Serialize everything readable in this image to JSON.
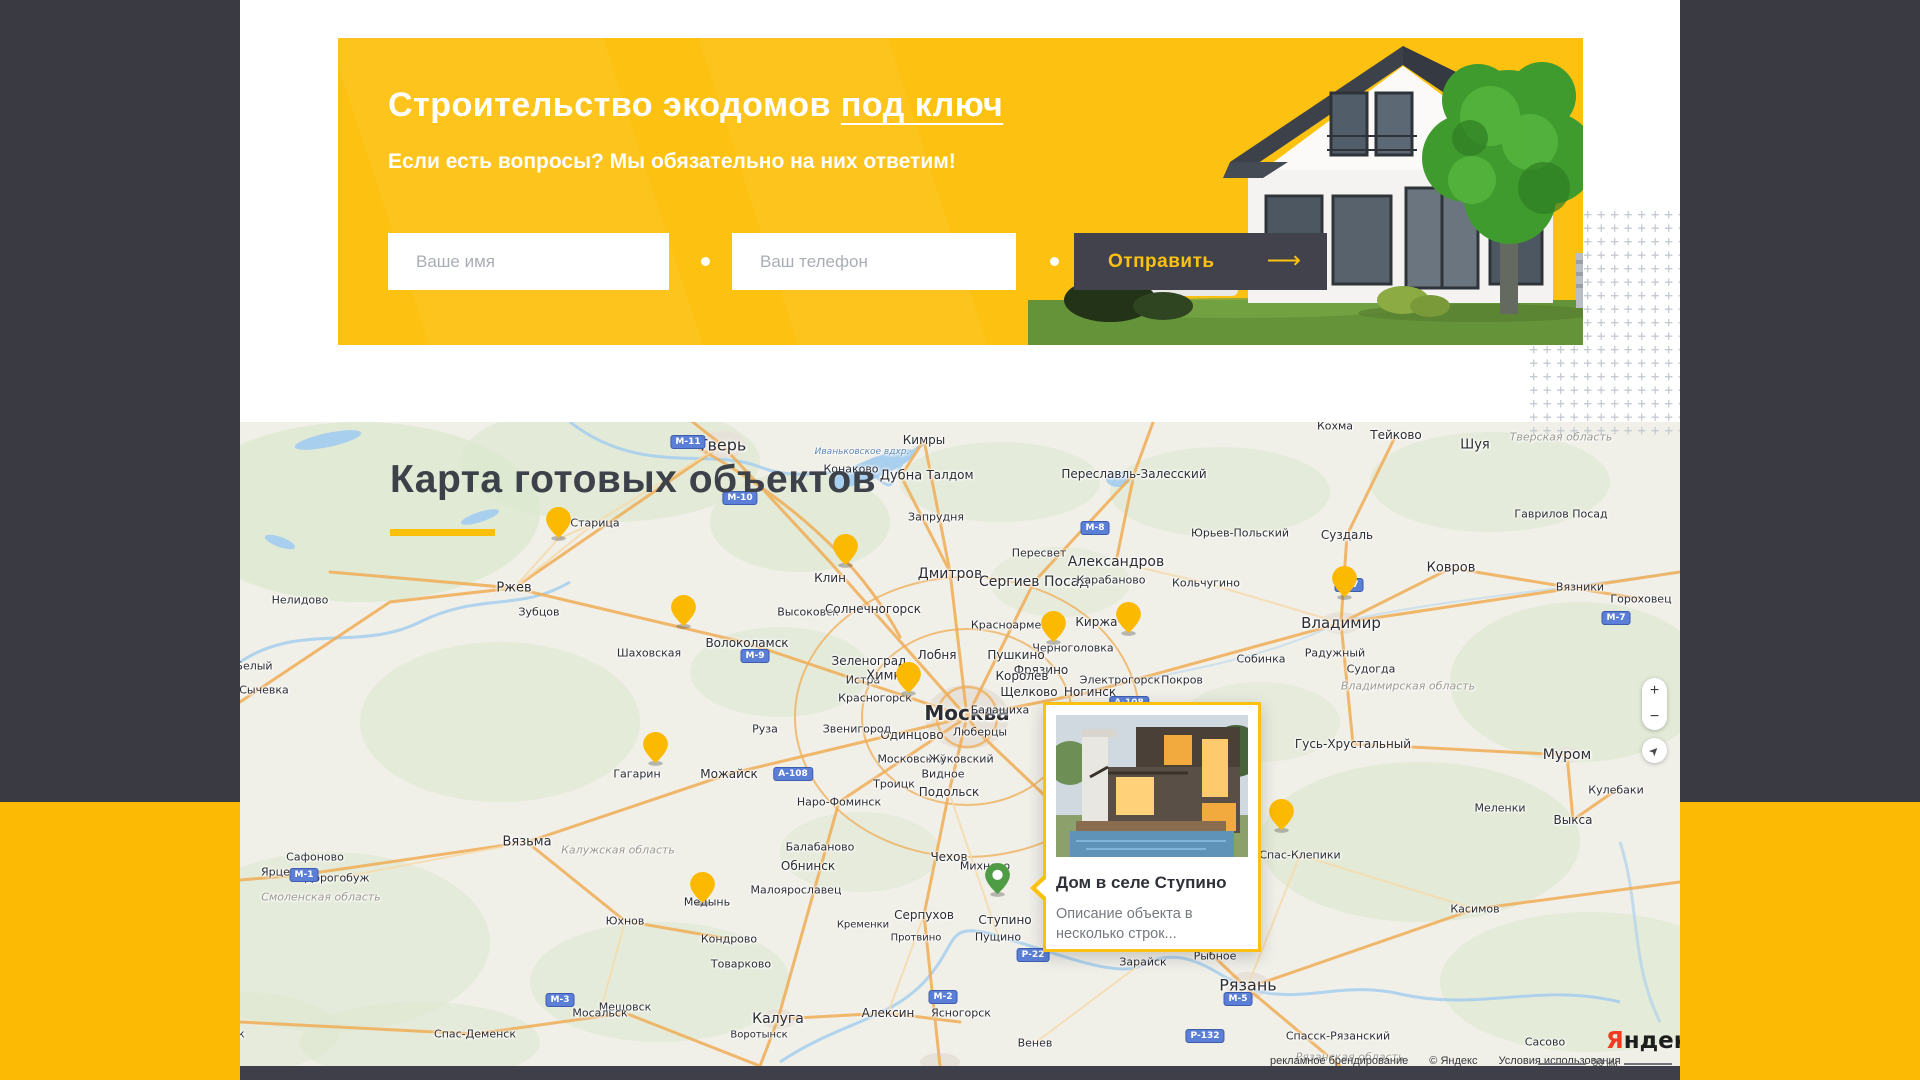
{
  "banner": {
    "title_main": "Строительство экодомов",
    "title_underlined": "под ключ",
    "subtitle": "Если есть вопросы? Мы обязательно на них ответим!",
    "form": {
      "name_placeholder": "Ваше имя",
      "phone_placeholder": "Ваш телефон",
      "submit_label": "Отправить",
      "submit_arrow": "⟶"
    }
  },
  "map_section": {
    "title": "Карта готовых объектов",
    "popup": {
      "title": "Дом в селе Ступино",
      "description": "Описание объекта в несколько строк..."
    },
    "controls": {
      "zoom_in": "+",
      "zoom_out": "−",
      "geolocate_icon": "➤"
    },
    "logo": {
      "first_letter": "Я",
      "rest": "ндекс"
    },
    "scale_label": "30 км",
    "attribution_left": "рекламное брендирование",
    "attribution_copyright": "© Яндекс",
    "attribution_terms": "Условия использования",
    "colors": {
      "pin_yellow": "#fcb902",
      "pin_green": "#4e9c44",
      "accent": "#fdc111"
    },
    "pins": [
      {
        "x": 318,
        "y": 117,
        "color": "yellow"
      },
      {
        "x": 605,
        "y": 144,
        "color": "yellow"
      },
      {
        "x": 443,
        "y": 205,
        "color": "yellow"
      },
      {
        "x": 813,
        "y": 221,
        "color": "yellow"
      },
      {
        "x": 888,
        "y": 212,
        "color": "yellow"
      },
      {
        "x": 1104,
        "y": 176,
        "color": "yellow"
      },
      {
        "x": 668,
        "y": 272,
        "color": "yellow"
      },
      {
        "x": 415,
        "y": 342,
        "color": "yellow"
      },
      {
        "x": 1041,
        "y": 409,
        "color": "yellow"
      },
      {
        "x": 462,
        "y": 482,
        "color": "yellow"
      },
      {
        "x": 757,
        "y": 473,
        "color": "green"
      }
    ],
    "labels": [
      {
        "t": "Тверь",
        "x": 482,
        "y": 23,
        "s": 16,
        "k": "c"
      },
      {
        "t": "Кимры",
        "x": 684,
        "y": 18,
        "s": 12,
        "k": "c"
      },
      {
        "t": "Конаково",
        "x": 611,
        "y": 47,
        "s": 11,
        "k": "c"
      },
      {
        "t": "Иваньковское вдхр.",
        "x": 622,
        "y": 30,
        "s": 9,
        "k": "w"
      },
      {
        "t": "Дубна",
        "x": 661,
        "y": 54,
        "s": 13,
        "k": "c"
      },
      {
        "t": "Талдом",
        "x": 710,
        "y": 53,
        "s": 12,
        "k": "c"
      },
      {
        "t": "Запрудня",
        "x": 696,
        "y": 95,
        "s": 11,
        "k": "c"
      },
      {
        "t": "Переславль-Залесский",
        "x": 894,
        "y": 52,
        "s": 12,
        "k": "c"
      },
      {
        "t": "Кохма",
        "x": 1095,
        "y": 4,
        "s": 11,
        "k": "c"
      },
      {
        "t": "Тейково",
        "x": 1156,
        "y": 13,
        "s": 12,
        "k": "c"
      },
      {
        "t": "Шуя",
        "x": 1235,
        "y": 23,
        "s": 13,
        "k": "c"
      },
      {
        "t": "Тверская область",
        "x": 1321,
        "y": 15,
        "s": 11,
        "k": "r"
      },
      {
        "t": "Гаврилов Посад",
        "x": 1321,
        "y": 92,
        "s": 11,
        "k": "c"
      },
      {
        "t": "Юрьев-Польский",
        "x": 1000,
        "y": 111,
        "s": 11,
        "k": "c"
      },
      {
        "t": "Суздаль",
        "x": 1107,
        "y": 113,
        "s": 12,
        "k": "c"
      },
      {
        "t": "Ковров",
        "x": 1211,
        "y": 146,
        "s": 13,
        "k": "c"
      },
      {
        "t": "Вязники",
        "x": 1340,
        "y": 165,
        "s": 11,
        "k": "c"
      },
      {
        "t": "Гороховец",
        "x": 1401,
        "y": 177,
        "s": 11,
        "k": "c"
      },
      {
        "t": "Старица",
        "x": 355,
        "y": 101,
        "s": 11,
        "k": "c"
      },
      {
        "t": "Ржев",
        "x": 274,
        "y": 166,
        "s": 13,
        "k": "c"
      },
      {
        "t": "Зубцов",
        "x": 299,
        "y": 190,
        "s": 11,
        "k": "c"
      },
      {
        "t": "Нелидово",
        "x": 60,
        "y": 178,
        "s": 11,
        "k": "c"
      },
      {
        "t": "Белый",
        "x": 14,
        "y": 244,
        "s": 11,
        "k": "c"
      },
      {
        "t": "Сычевка",
        "x": 24,
        "y": 268,
        "s": 11,
        "k": "c"
      },
      {
        "t": "Пересвет",
        "x": 799,
        "y": 131,
        "s": 11,
        "k": "c"
      },
      {
        "t": "Александров",
        "x": 876,
        "y": 140,
        "s": 14,
        "k": "c"
      },
      {
        "t": "Дмитров",
        "x": 710,
        "y": 152,
        "s": 14,
        "k": "c"
      },
      {
        "t": "Сергиев Посад",
        "x": 794,
        "y": 160,
        "s": 14,
        "k": "c"
      },
      {
        "t": "Карабаново",
        "x": 871,
        "y": 158,
        "s": 11,
        "k": "c"
      },
      {
        "t": "Кольчугино",
        "x": 966,
        "y": 161,
        "s": 11,
        "k": "c"
      },
      {
        "t": "Клин",
        "x": 590,
        "y": 156,
        "s": 12,
        "k": "c"
      },
      {
        "t": "Высоковск",
        "x": 568,
        "y": 190,
        "s": 11,
        "k": "c"
      },
      {
        "t": "Солнечногорск",
        "x": 633,
        "y": 187,
        "s": 12,
        "k": "c"
      },
      {
        "t": "Красноармейск",
        "x": 776,
        "y": 203,
        "s": 11,
        "k": "c"
      },
      {
        "t": "Киржач",
        "x": 860,
        "y": 200,
        "s": 12,
        "k": "c"
      },
      {
        "t": "Черноголовка",
        "x": 833,
        "y": 226,
        "s": 11,
        "k": "c"
      },
      {
        "t": "Электрогорск",
        "x": 880,
        "y": 258,
        "s": 11,
        "k": "c"
      },
      {
        "t": "Покров",
        "x": 942,
        "y": 258,
        "s": 11,
        "k": "c"
      },
      {
        "t": "Собинка",
        "x": 1021,
        "y": 237,
        "s": 11,
        "k": "c"
      },
      {
        "t": "Радужный",
        "x": 1095,
        "y": 231,
        "s": 11,
        "k": "c"
      },
      {
        "t": "Судогда",
        "x": 1131,
        "y": 247,
        "s": 11,
        "k": "c"
      },
      {
        "t": "Владимирская область",
        "x": 1168,
        "y": 264,
        "s": 11,
        "k": "r"
      },
      {
        "t": "Владимир",
        "x": 1101,
        "y": 201,
        "s": 15,
        "k": "c"
      },
      {
        "t": "Волоколамск",
        "x": 507,
        "y": 221,
        "s": 12,
        "k": "c"
      },
      {
        "t": "Шаховская",
        "x": 409,
        "y": 231,
        "s": 11,
        "k": "c"
      },
      {
        "t": "Зеленоград",
        "x": 629,
        "y": 239,
        "s": 12,
        "k": "c"
      },
      {
        "t": "Лобня",
        "x": 697,
        "y": 233,
        "s": 12,
        "k": "c"
      },
      {
        "t": "Пушкино",
        "x": 776,
        "y": 233,
        "s": 12,
        "k": "c"
      },
      {
        "t": "Фрязино",
        "x": 801,
        "y": 248,
        "s": 12,
        "k": "c"
      },
      {
        "t": "Истра",
        "x": 623,
        "y": 258,
        "s": 11,
        "k": "c"
      },
      {
        "t": "Химки",
        "x": 648,
        "y": 254,
        "s": 13,
        "k": "c"
      },
      {
        "t": "Королев",
        "x": 782,
        "y": 254,
        "s": 12,
        "k": "c"
      },
      {
        "t": "Щелково",
        "x": 789,
        "y": 270,
        "s": 12,
        "k": "c"
      },
      {
        "t": "Ногинск",
        "x": 850,
        "y": 270,
        "s": 12,
        "k": "c"
      },
      {
        "t": "Москва",
        "x": 727,
        "y": 291,
        "s": 20,
        "k": "c b"
      },
      {
        "t": "Красногорск",
        "x": 635,
        "y": 276,
        "s": 11,
        "k": "c"
      },
      {
        "t": "Балашиха",
        "x": 760,
        "y": 288,
        "s": 11,
        "k": "c"
      },
      {
        "t": "Люберцы",
        "x": 740,
        "y": 310,
        "s": 11,
        "k": "c"
      },
      {
        "t": "Одинцово",
        "x": 672,
        "y": 313,
        "s": 12,
        "k": "c"
      },
      {
        "t": "Звенигород",
        "x": 617,
        "y": 307,
        "s": 11,
        "k": "c"
      },
      {
        "t": "Руза",
        "x": 525,
        "y": 307,
        "s": 11,
        "k": "c"
      },
      {
        "t": "Можайск",
        "x": 489,
        "y": 352,
        "s": 12,
        "k": "c"
      },
      {
        "t": "Гагарин",
        "x": 397,
        "y": 352,
        "s": 11,
        "k": "c"
      },
      {
        "t": "Московский",
        "x": 672,
        "y": 337,
        "s": 11,
        "k": "c"
      },
      {
        "t": "Жуковский",
        "x": 721,
        "y": 337,
        "s": 11,
        "k": "c"
      },
      {
        "t": "Видное",
        "x": 703,
        "y": 352,
        "s": 11,
        "k": "c"
      },
      {
        "t": "Подольск",
        "x": 709,
        "y": 370,
        "s": 12,
        "k": "c"
      },
      {
        "t": "Троицк",
        "x": 654,
        "y": 362,
        "s": 11,
        "k": "c"
      },
      {
        "t": "Наро-Фоминск",
        "x": 599,
        "y": 380,
        "s": 11,
        "k": "c"
      },
      {
        "t": "Гусь-Хрустальный",
        "x": 1113,
        "y": 322,
        "s": 12,
        "k": "c"
      },
      {
        "t": "Муром",
        "x": 1327,
        "y": 333,
        "s": 14,
        "k": "c"
      },
      {
        "t": "Кулебаки",
        "x": 1376,
        "y": 368,
        "s": 11,
        "k": "c"
      },
      {
        "t": "Меленки",
        "x": 1260,
        "y": 386,
        "s": 11,
        "k": "c"
      },
      {
        "t": "Выкса",
        "x": 1333,
        "y": 398,
        "s": 12,
        "k": "c"
      },
      {
        "t": "Вязьма",
        "x": 287,
        "y": 420,
        "s": 13,
        "k": "c"
      },
      {
        "t": "Сафоново",
        "x": 75,
        "y": 435,
        "s": 11,
        "k": "c"
      },
      {
        "t": "Ярцево",
        "x": 42,
        "y": 450,
        "s": 11,
        "k": "c"
      },
      {
        "t": "Дорогобуж",
        "x": 97,
        "y": 456,
        "s": 11,
        "k": "c"
      },
      {
        "t": "Смоленская область",
        "x": 81,
        "y": 475,
        "s": 11,
        "k": "r"
      },
      {
        "t": "Калужская область",
        "x": 378,
        "y": 428,
        "s": 11,
        "k": "r"
      },
      {
        "t": "Балабаново",
        "x": 580,
        "y": 425,
        "s": 11,
        "k": "c"
      },
      {
        "t": "Обнинск",
        "x": 568,
        "y": 444,
        "s": 12,
        "k": "c"
      },
      {
        "t": "Малоярославец",
        "x": 556,
        "y": 468,
        "s": 11,
        "k": "c"
      },
      {
        "t": "Чехов",
        "x": 709,
        "y": 435,
        "s": 12,
        "k": "c"
      },
      {
        "t": "Серпухов",
        "x": 684,
        "y": 493,
        "s": 12,
        "k": "c"
      },
      {
        "t": "Кременки",
        "x": 623,
        "y": 503,
        "s": 10,
        "k": "c"
      },
      {
        "t": "Протвино",
        "x": 676,
        "y": 516,
        "s": 10,
        "k": "c"
      },
      {
        "t": "Пущино",
        "x": 758,
        "y": 515,
        "s": 11,
        "k": "c"
      },
      {
        "t": "Михнево",
        "x": 745,
        "y": 444,
        "s": 11,
        "k": "c"
      },
      {
        "t": "Ступино",
        "x": 765,
        "y": 498,
        "s": 12,
        "k": "c"
      },
      {
        "t": "Юхнов",
        "x": 385,
        "y": 499,
        "s": 11,
        "k": "c"
      },
      {
        "t": "Медынь",
        "x": 467,
        "y": 480,
        "s": 11,
        "k": "c"
      },
      {
        "t": "Кондрово",
        "x": 489,
        "y": 517,
        "s": 11,
        "k": "c"
      },
      {
        "t": "Товарково",
        "x": 501,
        "y": 542,
        "s": 11,
        "k": "c"
      },
      {
        "t": "Мещовск",
        "x": 385,
        "y": 585,
        "s": 11,
        "k": "c"
      },
      {
        "t": "Мосальск",
        "x": 360,
        "y": 591,
        "s": 11,
        "k": "c"
      },
      {
        "t": "Спас-Деменск",
        "x": 235,
        "y": 612,
        "s": 11,
        "k": "c"
      },
      {
        "t": "Починок",
        "x": -20,
        "y": 612,
        "s": 11,
        "k": "c"
      },
      {
        "t": "Калуга",
        "x": 538,
        "y": 597,
        "s": 14,
        "k": "c"
      },
      {
        "t": "Воротынск",
        "x": 519,
        "y": 613,
        "s": 10,
        "k": "c"
      },
      {
        "t": "Алексин",
        "x": 648,
        "y": 591,
        "s": 12,
        "k": "c"
      },
      {
        "t": "Ясногорск",
        "x": 721,
        "y": 591,
        "s": 11,
        "k": "c"
      },
      {
        "t": "Венев",
        "x": 795,
        "y": 621,
        "s": 11,
        "k": "c"
      },
      {
        "t": "Зарайск",
        "x": 903,
        "y": 540,
        "s": 11,
        "k": "c"
      },
      {
        "t": "Рыбное",
        "x": 975,
        "y": 534,
        "s": 11,
        "k": "c"
      },
      {
        "t": "Рязань",
        "x": 1008,
        "y": 563,
        "s": 16,
        "k": "c"
      },
      {
        "t": "Спас-Клепики",
        "x": 1060,
        "y": 433,
        "s": 11,
        "k": "c"
      },
      {
        "t": "Касимов",
        "x": 1235,
        "y": 487,
        "s": 11,
        "k": "c"
      },
      {
        "t": "Спасск-Рязанский",
        "x": 1098,
        "y": 614,
        "s": 11,
        "k": "c"
      },
      {
        "t": "Рязанская область",
        "x": 1110,
        "y": 635,
        "s": 11,
        "k": "r"
      },
      {
        "t": "Сасово",
        "x": 1305,
        "y": 620,
        "s": 11,
        "k": "c"
      }
    ],
    "badges": [
      {
        "t": "М-11",
        "x": 448,
        "y": 20
      },
      {
        "t": "М-10",
        "x": 500,
        "y": 76
      },
      {
        "t": "М-8",
        "x": 855,
        "y": 106
      },
      {
        "t": "М-9",
        "x": 515,
        "y": 234
      },
      {
        "t": "М-7",
        "x": 1109,
        "y": 163
      },
      {
        "t": "М-7",
        "x": 1376,
        "y": 196
      },
      {
        "t": "А-108",
        "x": 889,
        "y": 281
      },
      {
        "t": "А-108",
        "x": 553,
        "y": 352
      },
      {
        "t": "М-1",
        "x": 64,
        "y": 453
      },
      {
        "t": "М-3",
        "x": 320,
        "y": 578
      },
      {
        "t": "М-2",
        "x": 703,
        "y": 575
      },
      {
        "t": "Р-22",
        "x": 793,
        "y": 533
      },
      {
        "t": "Р-132",
        "x": 965,
        "y": 614
      },
      {
        "t": "М-5",
        "x": 998,
        "y": 577
      }
    ]
  }
}
